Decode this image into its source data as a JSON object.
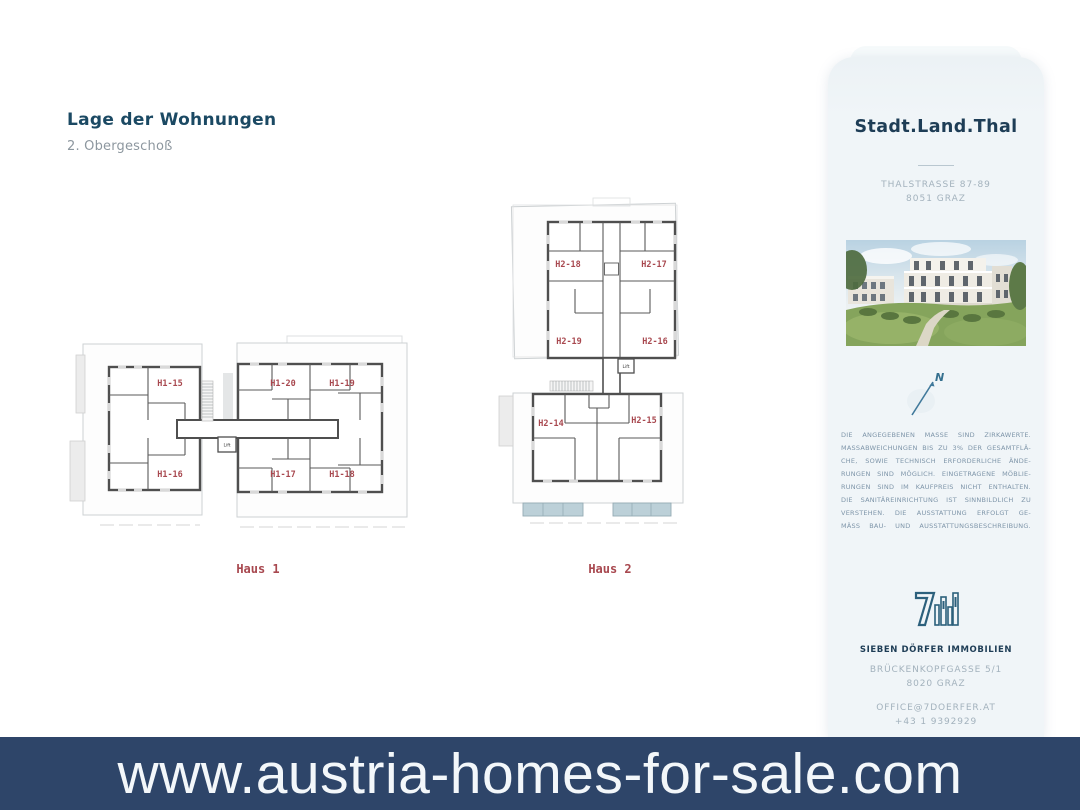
{
  "header": {
    "title": "Lage der Wohnungen",
    "subtitle": "2. Obergeschoß"
  },
  "plans": {
    "haus1": {
      "label": "Haus 1",
      "lift": "Lift",
      "units": [
        "H1-15",
        "H1-16",
        "H1-20",
        "H1-19",
        "H1-17",
        "H1-18"
      ]
    },
    "haus2": {
      "label": "Haus 2",
      "lift": "Lift",
      "units": [
        "H2-18",
        "H2-17",
        "H2-19",
        "H2-16",
        "H2-14",
        "H2-15"
      ]
    }
  },
  "sidebar": {
    "brand": "Stadt.Land.Thal",
    "address_line1": "THALSTRASSE 87-89",
    "address_line2": "8051 GRAZ",
    "compass_label": "N",
    "disclaimer_lines": [
      "DIE ANGEGEBENEN MASSE SIND ZIRKAWERTE.",
      "MASSABWEICHUNGEN BIS ZU 3% DER GESAMTFLÄ-",
      "CHE, SOWIE TECHNISCH ERFORDERLICHE ÄNDE-",
      "RUNGEN SIND MÖGLICH. EINGETRAGENE MÖBLIE-",
      "RUNGEN SIND IM KAUFPREIS NICHT ENTHALTEN.",
      "DIE SANITÄREINRICHTUNG IST SINNBILDLICH ZU",
      "VERSTEHEN. DIE AUSSTATTUNG ERFOLGT GE-",
      "MÄSS BAU- UND AUSSTATTUNGSBESCHREIBUNG."
    ],
    "agency": "SIEBEN DÖRFER IMMOBILIEN",
    "agency_address_line1": "BRÜCKENKOPFGASSE 5/1",
    "agency_address_line2": "8020 GRAZ",
    "email": "OFFICE@7DOERFER.AT",
    "phone": "+43 1 9392929"
  },
  "footer": {
    "website": "www.austria-homes-for-sale.com"
  },
  "colors": {
    "banner_bg": "#2e4569",
    "unit_label_red": "#a8484f",
    "brand_navy": "#1e3d56",
    "accent_teal": "#2c607c",
    "sidebar_bg": "#eff4f7",
    "balcony_teal": "#bcd0d8"
  }
}
